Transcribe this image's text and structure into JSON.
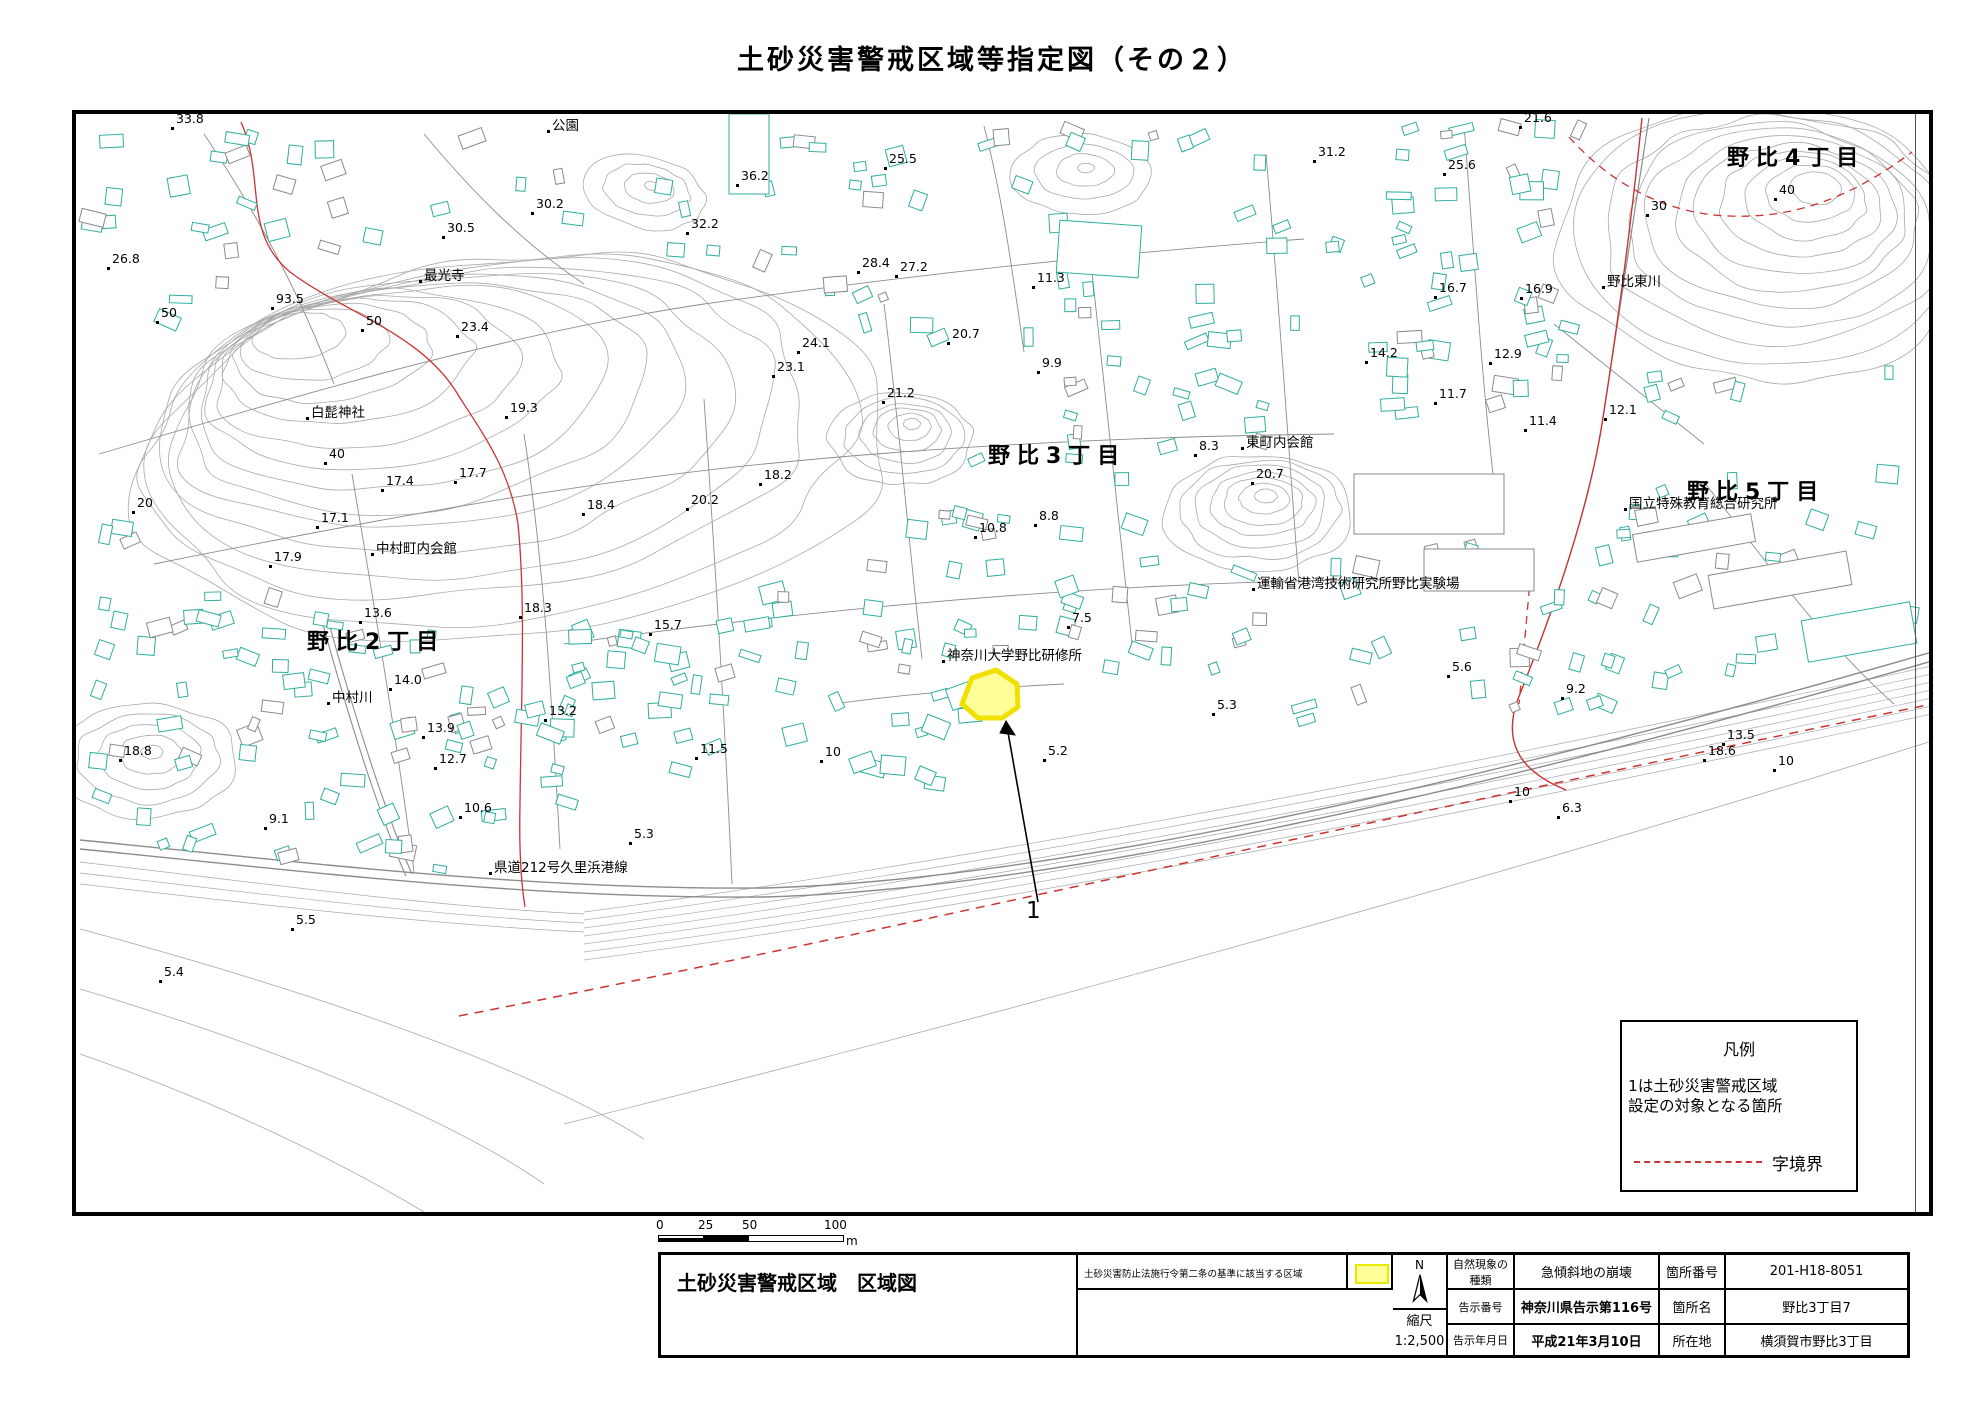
{
  "page_title": "土砂災害警戒区域等指定図（その２）",
  "legend": {
    "title": "凡例",
    "body_line1": "1は土砂災害警戒区域",
    "body_line2": "設定の対象となる箇所",
    "boundary_label": "字境界"
  },
  "scale_bar": {
    "ticks": [
      "0",
      "25",
      "50",
      "100"
    ],
    "unit": "m"
  },
  "title_block": {
    "map_title": "土砂災害警戒区域　区域図",
    "criteria_text": "土砂災害防止法施行令第二条の基準に該当する区域",
    "north_label": "N",
    "scale_label": "縮尺",
    "scale_value": "1:2,500",
    "rows": [
      {
        "label": "自然現象の種類",
        "value": "急傾斜地の崩壊",
        "label2": "箇所番号",
        "value2": "201-H18-8051"
      },
      {
        "label": "告示番号",
        "value": "神奈川県告示第116号",
        "label2": "箇所名",
        "value2": "野比3丁目7"
      },
      {
        "label": "告示年月日",
        "value": "平成21年3月10日",
        "label2": "所在地",
        "value2": "横須賀市野比3丁目"
      }
    ]
  },
  "map": {
    "marker_label": "1",
    "districts": [
      {
        "text": "野比4丁目",
        "x": 1727,
        "y": 140
      },
      {
        "text": "野比3丁目",
        "x": 988,
        "y": 438
      },
      {
        "text": "野比5丁目",
        "x": 1687,
        "y": 474
      },
      {
        "text": "野比2丁目",
        "x": 307,
        "y": 624
      }
    ],
    "places": [
      {
        "text": "公園",
        "x": 548,
        "y": 131
      },
      {
        "text": "最光寺",
        "x": 420,
        "y": 281
      },
      {
        "text": "白髭神社",
        "x": 307,
        "y": 418
      },
      {
        "text": "野比東川",
        "x": 1603,
        "y": 287
      },
      {
        "text": "東町内会館",
        "x": 1242,
        "y": 448
      },
      {
        "text": "国立特殊教育総合研究所",
        "x": 1625,
        "y": 509
      },
      {
        "text": "運輸省港湾技術研究所野比実験場",
        "x": 1253,
        "y": 589
      },
      {
        "text": "中村町内会館",
        "x": 372,
        "y": 554
      },
      {
        "text": "中村川",
        "x": 328,
        "y": 703
      },
      {
        "text": "神奈川大学野比研修所",
        "x": 943,
        "y": 661
      },
      {
        "text": "県道212号久里浜港線",
        "x": 490,
        "y": 873
      }
    ],
    "elevations": [
      {
        "text": "33.8",
        "x": 172,
        "y": 128
      },
      {
        "text": "30.2",
        "x": 532,
        "y": 213
      },
      {
        "text": "30.5",
        "x": 443,
        "y": 237
      },
      {
        "text": "36.2",
        "x": 737,
        "y": 185
      },
      {
        "text": "25.5",
        "x": 885,
        "y": 168
      },
      {
        "text": "32.2",
        "x": 687,
        "y": 233
      },
      {
        "text": "31.2",
        "x": 1314,
        "y": 161
      },
      {
        "text": "25.6",
        "x": 1444,
        "y": 174
      },
      {
        "text": "21.6",
        "x": 1520,
        "y": 127
      },
      {
        "text": "40",
        "x": 1775,
        "y": 199
      },
      {
        "text": "30",
        "x": 1647,
        "y": 215
      },
      {
        "text": "26.8",
        "x": 108,
        "y": 268
      },
      {
        "text": "93.5",
        "x": 272,
        "y": 308
      },
      {
        "text": "50",
        "x": 157,
        "y": 322
      },
      {
        "text": "50",
        "x": 362,
        "y": 330
      },
      {
        "text": "23.4",
        "x": 457,
        "y": 336
      },
      {
        "text": "19.3",
        "x": 506,
        "y": 417
      },
      {
        "text": "28.4",
        "x": 858,
        "y": 272
      },
      {
        "text": "27.2",
        "x": 896,
        "y": 276
      },
      {
        "text": "24.1",
        "x": 798,
        "y": 352
      },
      {
        "text": "23.1",
        "x": 773,
        "y": 376
      },
      {
        "text": "21.2",
        "x": 883,
        "y": 402
      },
      {
        "text": "20.7",
        "x": 948,
        "y": 343
      },
      {
        "text": "9.9",
        "x": 1038,
        "y": 372
      },
      {
        "text": "11.3",
        "x": 1033,
        "y": 287
      },
      {
        "text": "14.2",
        "x": 1366,
        "y": 362
      },
      {
        "text": "16.7",
        "x": 1435,
        "y": 297
      },
      {
        "text": "16.9",
        "x": 1521,
        "y": 298
      },
      {
        "text": "12.9",
        "x": 1490,
        "y": 363
      },
      {
        "text": "12.1",
        "x": 1605,
        "y": 419
      },
      {
        "text": "11.4",
        "x": 1525,
        "y": 430
      },
      {
        "text": "11.7",
        "x": 1435,
        "y": 403
      },
      {
        "text": "8.3",
        "x": 1195,
        "y": 455
      },
      {
        "text": "20.7",
        "x": 1252,
        "y": 483
      },
      {
        "text": "20",
        "x": 133,
        "y": 512
      },
      {
        "text": "40",
        "x": 325,
        "y": 463
      },
      {
        "text": "17.4",
        "x": 382,
        "y": 490
      },
      {
        "text": "17.7",
        "x": 455,
        "y": 482
      },
      {
        "text": "17.1",
        "x": 317,
        "y": 527
      },
      {
        "text": "17.9",
        "x": 270,
        "y": 566
      },
      {
        "text": "13.6",
        "x": 360,
        "y": 622
      },
      {
        "text": "18.3",
        "x": 520,
        "y": 617
      },
      {
        "text": "18.2",
        "x": 760,
        "y": 484
      },
      {
        "text": "20.2",
        "x": 687,
        "y": 509
      },
      {
        "text": "18.4",
        "x": 583,
        "y": 514
      },
      {
        "text": "15.7",
        "x": 650,
        "y": 634
      },
      {
        "text": "14.0",
        "x": 390,
        "y": 689
      },
      {
        "text": "13.2",
        "x": 545,
        "y": 720
      },
      {
        "text": "11.5",
        "x": 696,
        "y": 758
      },
      {
        "text": "10",
        "x": 821,
        "y": 761
      },
      {
        "text": "18.8",
        "x": 120,
        "y": 760
      },
      {
        "text": "13.9",
        "x": 423,
        "y": 737
      },
      {
        "text": "12.7",
        "x": 435,
        "y": 768
      },
      {
        "text": "10.6",
        "x": 460,
        "y": 817
      },
      {
        "text": "9.1",
        "x": 265,
        "y": 828
      },
      {
        "text": "10.8",
        "x": 975,
        "y": 537
      },
      {
        "text": "8.8",
        "x": 1035,
        "y": 525
      },
      {
        "text": "7.5",
        "x": 1068,
        "y": 627
      },
      {
        "text": "5.3",
        "x": 1213,
        "y": 714
      },
      {
        "text": "5.2",
        "x": 1044,
        "y": 760
      },
      {
        "text": "5.6",
        "x": 1448,
        "y": 676
      },
      {
        "text": "9.2",
        "x": 1562,
        "y": 698
      },
      {
        "text": "13.5",
        "x": 1723,
        "y": 744
      },
      {
        "text": "18.6",
        "x": 1704,
        "y": 760
      },
      {
        "text": "10",
        "x": 1774,
        "y": 770
      },
      {
        "text": "10",
        "x": 1510,
        "y": 801
      },
      {
        "text": "6.3",
        "x": 1558,
        "y": 817
      },
      {
        "text": "5.3",
        "x": 630,
        "y": 843
      },
      {
        "text": "5.5",
        "x": 292,
        "y": 929
      },
      {
        "text": "5.4",
        "x": 160,
        "y": 981
      }
    ]
  },
  "colors": {
    "contour": "#a9a9a9",
    "building": "#2fae9e",
    "building_alt": "#8a8a8a",
    "road": "#8c8c8c",
    "boundary_red": "#cc3333",
    "highlight_fill": "#ffff99",
    "highlight_stroke": "#f0e000"
  }
}
